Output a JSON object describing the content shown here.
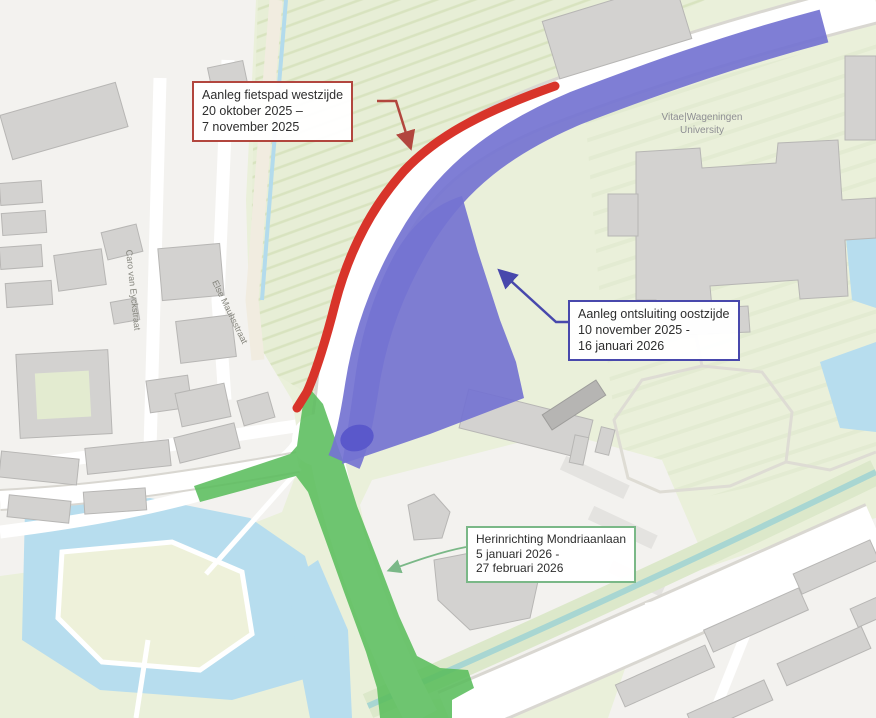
{
  "figure": {
    "kind": "construction-phasing-map",
    "map_labels": {
      "university_line1": "Vitae|Wageningen",
      "university_line2": "University",
      "street_1": "Caro van Eyckstraat",
      "street_2": "Else Mauhsstraat"
    },
    "callouts": [
      {
        "id": "fietspad-westzijde",
        "border_color": "#b2463e",
        "lines": [
          "Aanleg fietspad westzijde",
          "20 oktober 2025 –",
          "7 november 2025"
        ]
      },
      {
        "id": "ontsluiting-oostzijde",
        "border_color": "#4848ac",
        "lines": [
          "Aanleg ontsluiting oostzijde",
          "10 november 2025 -",
          "16 januari 2026"
        ]
      },
      {
        "id": "mondriaanlaan",
        "border_color": "#7ab887",
        "lines": [
          "Herinrichting Mondriaanlaan",
          "5 januari 2026 -",
          "27 februari 2026"
        ]
      }
    ],
    "colors": {
      "phase1_red": "#d8342a",
      "phase2_blue": "#7473d1",
      "phase2_blue_dark": "#5a58cb",
      "phase3_green": "#5abd5c",
      "water": "#b7ddee",
      "field": "#eaf0da",
      "orchard": "#e7eed6",
      "urban": "#f3f2ef",
      "building": "#d3d2d0",
      "building_edge": "#b7b6b4"
    }
  }
}
